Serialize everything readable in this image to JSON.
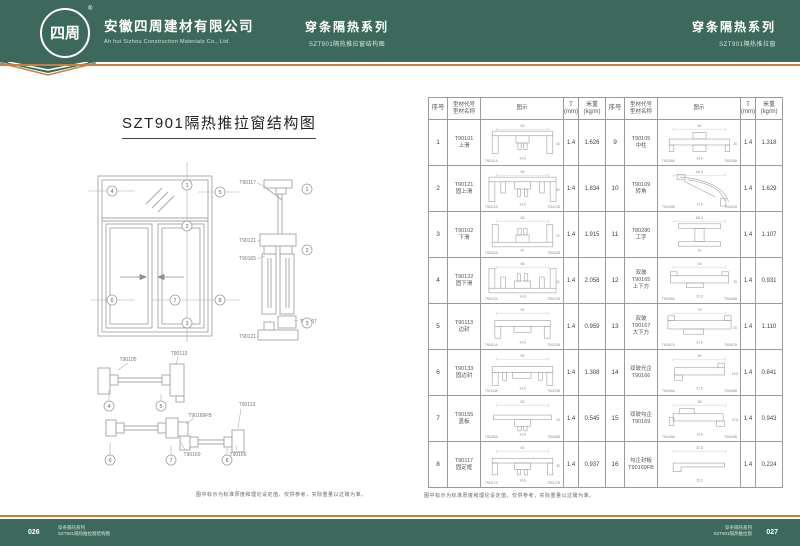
{
  "theme": {
    "teal": "#3c695c",
    "orange": "#c9803c",
    "drawing_gray": "#a4a4a4",
    "text_gray": "#555555"
  },
  "header": {
    "logo_text": "四周",
    "logo_reg": "®",
    "company_cn": "安徽四周建材有限公司",
    "company_en": "Ah hui Sizhou Construction Materials Co., Ltd.",
    "center_series": "穿条隔热系列",
    "center_sub": "SZT901隔热推拉窗结构图",
    "right_series": "穿条隔热系列",
    "right_sub": "SZT901隔热推拉窗"
  },
  "left_page": {
    "title": "SZT901隔热推拉窗结构图",
    "caption": "图中标示为标准厚度和理论设定值，仅供参考，实际重量以过磅为准。",
    "markers": {
      "n1": "1",
      "n2": "2",
      "n3": "3",
      "n4": "4",
      "n5": "5",
      "n6": "6",
      "n7": "7",
      "n8": "8"
    },
    "labels": {
      "v1": "T90117",
      "v2": "T90121",
      "v3": "T90165",
      "v4": "T90167",
      "v5": "T90121",
      "m1": "T90105",
      "m2": "T90113",
      "b1": "T90169FB",
      "b2": "T90113",
      "b3": "T90169",
      "b4": "T90166"
    }
  },
  "right_page": {
    "caption": "图中标示为标准厚度和理论设定值，仅供参考，实际重量以过磅为准。",
    "table": {
      "headers": {
        "no": "序号",
        "code": "型材代号\n型材名称",
        "fig": "图示",
        "t": "T\n(mm)",
        "kg": "米重\n(kg/m)"
      },
      "rows_a": [
        {
          "no": "1",
          "label_lines": [
            "T90101",
            "上滑"
          ],
          "shape": "topTrack",
          "dims": [
            "60",
            "14.8",
            "40"
          ],
          "subs": [
            "T90101A"
          ],
          "t": "1.4",
          "kg": "1.626"
        },
        {
          "no": "2",
          "label_lines": [
            "T90121",
            "固上滑"
          ],
          "shape": "fixTopTrack",
          "dims": [
            "66",
            "14.8",
            "40"
          ],
          "subs": [
            "T90121A",
            "T90121B"
          ],
          "t": "1.4",
          "kg": "1.834"
        },
        {
          "no": "3",
          "label_lines": [
            "T90102",
            "下滑"
          ],
          "shape": "bottomTrack",
          "dims": [
            "66",
            "40",
            "21"
          ],
          "subs": [
            "T90102A",
            "T90102B"
          ],
          "t": "1.4",
          "kg": "1.915"
        },
        {
          "no": "4",
          "label_lines": [
            "T90122",
            "固下滑"
          ],
          "shape": "fixBottomTrack",
          "dims": [
            "66",
            "14.8",
            "21"
          ],
          "subs": [
            "T90122A",
            "T90122B"
          ],
          "t": "1.4",
          "kg": "2.058"
        },
        {
          "no": "5",
          "label_lines": [
            "T90113",
            "边封"
          ],
          "shape": "sideSeal",
          "dims": [
            "90",
            "14.8"
          ],
          "subs": [
            "T90113A",
            "T90113B"
          ],
          "t": "1.4",
          "kg": "0.959"
        },
        {
          "no": "6",
          "label_lines": [
            "T90133",
            "固边封"
          ],
          "shape": "fixSideSeal",
          "dims": [
            "90",
            "14.8"
          ],
          "subs": [
            "T90133A",
            "T90133B"
          ],
          "t": "1.4",
          "kg": "1.308"
        },
        {
          "no": "7",
          "label_lines": [
            "T90155",
            "盖板"
          ],
          "shape": "cover",
          "dims": [
            "60",
            "14.8",
            "25"
          ],
          "subs": [
            "T90155A",
            "T90155B"
          ],
          "t": "1.4",
          "kg": "0.545"
        },
        {
          "no": "8",
          "label_lines": [
            "T90117",
            "固定框"
          ],
          "shape": "fixFrame",
          "dims": [
            "60",
            "14.8",
            "30"
          ],
          "subs": [
            "T90117A",
            "T90117B"
          ],
          "t": "1.4",
          "kg": "0.937"
        }
      ],
      "rows_b": [
        {
          "no": "9",
          "label_lines": [
            "T90105",
            "中柱"
          ],
          "shape": "mullion",
          "dims": [
            "60",
            "14.8",
            "35"
          ],
          "subs": [
            "T90105A",
            "T90105B"
          ],
          "t": "1.4",
          "kg": "1.318"
        },
        {
          "no": "10",
          "label_lines": [
            "T90109",
            "转角"
          ],
          "shape": "corner",
          "dims": [
            "64.3",
            "14.8"
          ],
          "subs": [
            "T90109B",
            "T90109A"
          ],
          "t": "1.4",
          "kg": "1.629"
        },
        {
          "no": "11",
          "label_lines": [
            "T80280",
            "工字"
          ],
          "shape": "ibar",
          "dims": [
            "65.6",
            "25"
          ],
          "subs": [],
          "t": "1.4",
          "kg": "1.107"
        },
        {
          "no": "12",
          "label_lines": [
            "双玻",
            "T90165",
            "上下方"
          ],
          "shape": "rail",
          "dims": [
            "63",
            "31.6",
            "25"
          ],
          "subs": [
            "T90165A",
            "T90165B"
          ],
          "t": "1.4",
          "kg": "0.931"
        },
        {
          "no": "13",
          "label_lines": [
            "双玻",
            "T90167",
            "大下方"
          ],
          "shape": "railBig",
          "dims": [
            "75",
            "31.6",
            "25"
          ],
          "subs": [
            "T90167A",
            "T90167B"
          ],
          "t": "1.4",
          "kg": "1.110"
        },
        {
          "no": "14",
          "label_lines": [
            "双玻光企",
            "T90166"
          ],
          "shape": "gStile",
          "dims": [
            "50",
            "31.6",
            "16.8"
          ],
          "subs": [
            "T90166A",
            "T90166B"
          ],
          "t": "1.4",
          "kg": "0.841"
        },
        {
          "no": "15",
          "label_lines": [
            "双玻勾企",
            "T90169"
          ],
          "shape": "hookStile",
          "dims": [
            "58",
            "14.8",
            "37.8"
          ],
          "subs": [
            "T90169A",
            "T90169B"
          ],
          "t": "1.4",
          "kg": "0.943"
        },
        {
          "no": "16",
          "label_lines": [
            "勾企封板",
            "T90169FB"
          ],
          "shape": "plate",
          "dims": [
            "37.8",
            "15.2"
          ],
          "subs": [],
          "t": "1.4",
          "kg": "0.224"
        }
      ]
    }
  },
  "footer": {
    "left_page_no": "026",
    "left_line1": "穿条隔热系列",
    "left_line2": "SZT901隔热推拉窗结构图",
    "right_line1": "穿条隔热系列",
    "right_line2": "SZT901隔热推拉窗",
    "right_page_no": "027"
  }
}
